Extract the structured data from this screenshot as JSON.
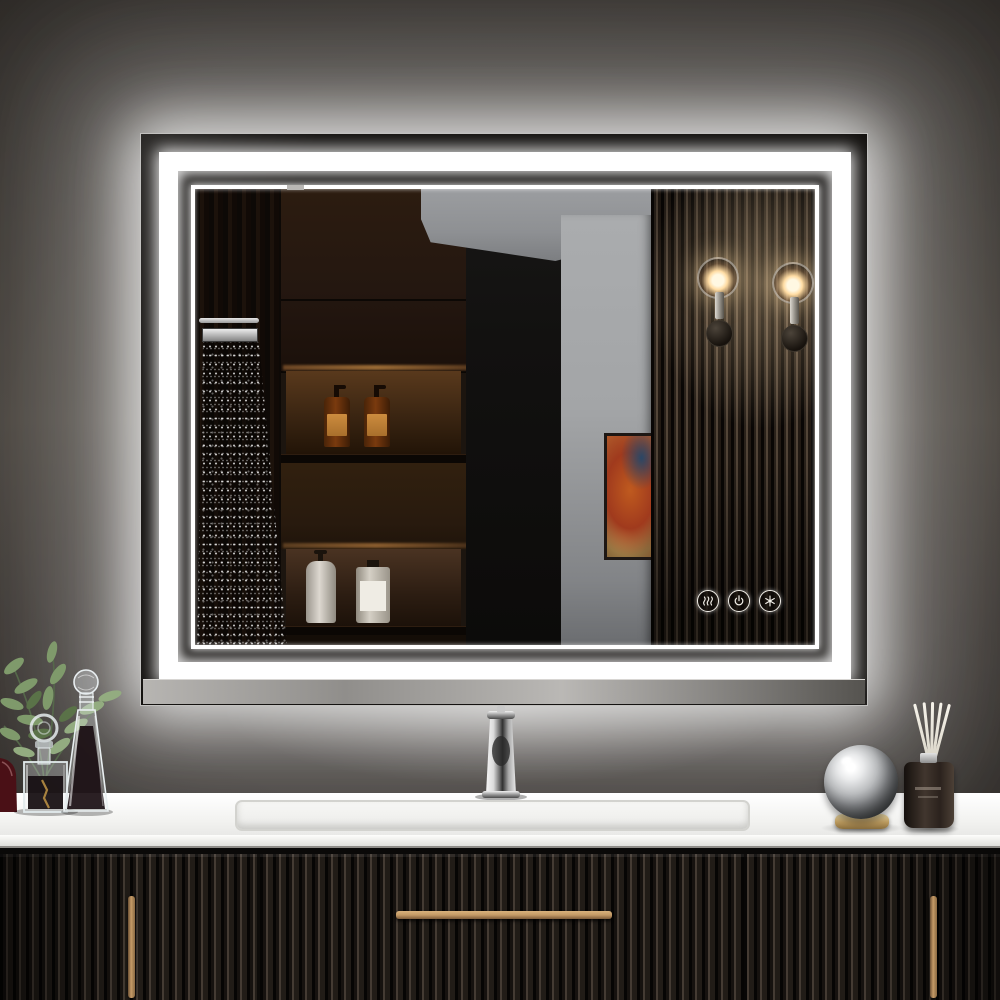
{
  "meta": {
    "description": "Product photograph of a rectangular LED backlit bathroom vanity mirror with double white LED light frame, mounted on a dark charcoal wall above a black fluted vanity with white countertop",
    "visible_text": "none"
  },
  "theme": {
    "wall_top": "#36322e",
    "wall_mid": "#45403a",
    "wall_low": "#2e2b28",
    "led_white": "#ffffff",
    "mirror_margin": "#141210",
    "niche_lit": "#59391c",
    "amber_bottle": "#7a3a0e",
    "amber_label": "#cc8c3e",
    "gray_wall": "#a3a5a7",
    "ceiling_gray": "#8e9093",
    "doorway": "#121110",
    "slat_dark": "#0a0705",
    "slat_light": "#5a4b3d",
    "sconce_warm": "#ffdca3",
    "art_orange": "#bf5a1f",
    "art_red": "#a03a1d",
    "art_blue": "#2a4766",
    "counter_white": "#f4f4f2",
    "cabinet_black": "#15110e",
    "brass": "#c49a66",
    "diffuser_dark": "#2b221d"
  },
  "mirror": {
    "label": "LED backlit mirror with halo glow",
    "frame": "double white LED frame: thick outer band and thin inner line",
    "touch_controls": [
      {
        "name": "defog",
        "icon": "defog-icon",
        "label": "Anti-fog touch sensor"
      },
      {
        "name": "power-dimmer",
        "icon": "power-icon",
        "label": "Power / dimmer touch sensor"
      },
      {
        "name": "color-temperature",
        "icon": "color-temp-icon",
        "label": "Color temperature touch sensor"
      }
    ]
  },
  "reflection": {
    "label": "Mirror reflection of bathroom interior",
    "objects": [
      {
        "name": "rain-shower",
        "label": "Rainfall shower head with water spray"
      },
      {
        "name": "wood-cabinets",
        "label": "Dark walnut wall cabinets and open shelves"
      },
      {
        "name": "amber-bottles",
        "label": "Two amber pump bottles with tan labels on lit shelf"
      },
      {
        "name": "white-bottles",
        "label": "Two white bottles on lower shelf"
      },
      {
        "name": "doorway",
        "label": "Dark doorway opening"
      },
      {
        "name": "gray-wall",
        "label": "Light gray hallway wall and ceiling"
      },
      {
        "name": "wall-art",
        "label": "Abstract art in orange, red and blue"
      },
      {
        "name": "slat-wall",
        "label": "Vertical wood slat panel wall"
      },
      {
        "name": "sconces",
        "label": "Two glass globe wall sconces with warm light"
      }
    ]
  },
  "vanity": {
    "label": "Black fluted floating vanity with white countertop",
    "countertop": {
      "label": "White stone countertop with integrated rectangular basin"
    },
    "faucet": {
      "label": "Polished chrome single-handle faucet"
    },
    "cabinet": {
      "label": "Fluted black cabinet: two doors and center drawer",
      "handles": "brushed brass bar handles"
    }
  },
  "decor": {
    "left": [
      {
        "name": "red-glass",
        "label": "Dark red glass object at left edge"
      },
      {
        "name": "plant",
        "label": "Green eucalyptus sprigs in square glass vase"
      },
      {
        "name": "glass-bottle",
        "label": "Ornate glass bottle with ring stopper"
      },
      {
        "name": "decanter",
        "label": "Tall conical glass decanter with dark liquid"
      }
    ],
    "right": [
      {
        "name": "mirror-sphere",
        "label": "Polished chrome sphere on brass ring base"
      },
      {
        "name": "reed-diffuser",
        "label": "Dark reed diffuser bottle with white reeds"
      }
    ]
  }
}
